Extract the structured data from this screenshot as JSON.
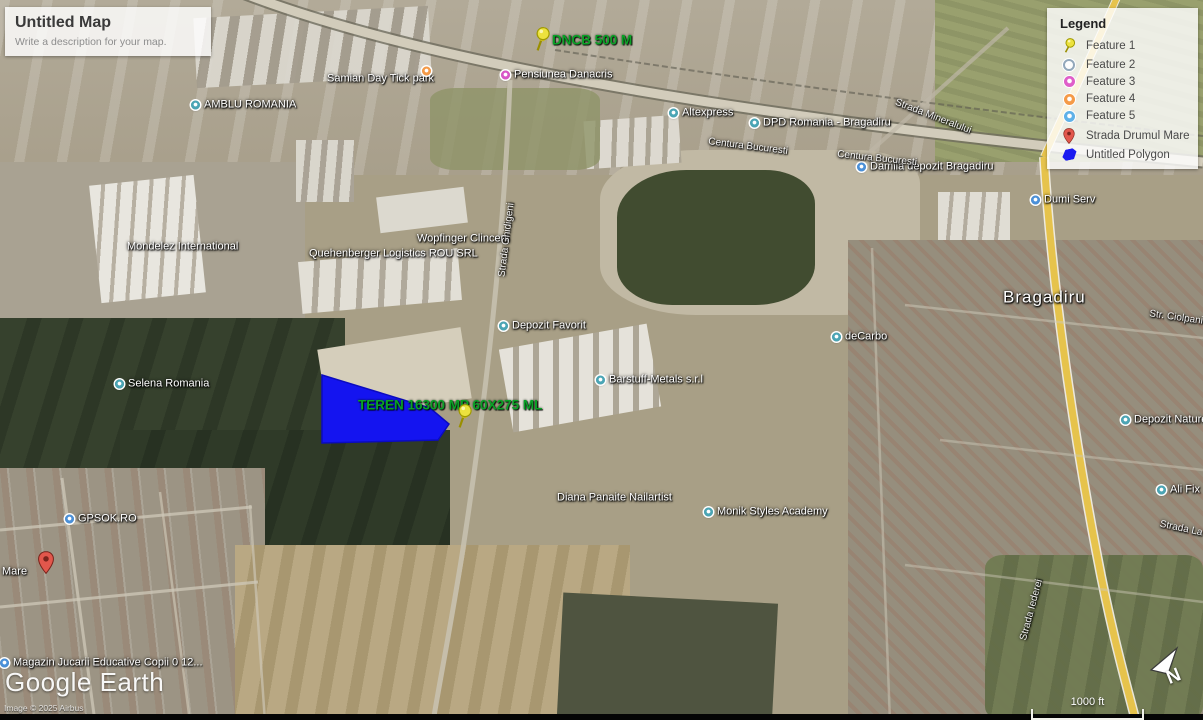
{
  "map_panel": {
    "title": "Untitled Map",
    "description": "Write a description for your map."
  },
  "legend": {
    "title": "Legend",
    "items": [
      {
        "label": "Feature 1",
        "icon": "pushpin",
        "color": "#ece23e"
      },
      {
        "label": "Feature 2",
        "icon": "ring",
        "color": "#93a8bb"
      },
      {
        "label": "Feature 3",
        "icon": "dot",
        "color": "#df5ec9"
      },
      {
        "label": "Feature 4",
        "icon": "dot",
        "color": "#f59a47"
      },
      {
        "label": "Feature 5",
        "icon": "dot",
        "color": "#5fb1e8"
      },
      {
        "label": "Strada Drumul Mare",
        "icon": "pin",
        "color": "#e2574c"
      },
      {
        "label": "Untitled Polygon",
        "icon": "polygon",
        "color": "#1a1af0"
      }
    ]
  },
  "colors": {
    "annotation_green": "#0aa226",
    "polygon_blue": "#1414f0",
    "pushpin_yellow": "#ece23e",
    "marker_red": "#e2574c"
  },
  "map": {
    "labels": [
      {
        "text": "DNCB 500 M",
        "type": "green",
        "x": 552,
        "y": 40
      },
      {
        "text": "TEREN 16300 MP 60X275 ML",
        "type": "green",
        "x": 358,
        "y": 405
      },
      {
        "text": "Samian Day Tick park",
        "type": "poi",
        "x": 327,
        "y": 79
      },
      {
        "text": "",
        "type": "poi",
        "icon": "#f59a47",
        "x": 422,
        "y": 71
      },
      {
        "text": "Pensiunea Danacris",
        "type": "poi",
        "icon": "#d856c8",
        "x": 501,
        "y": 75
      },
      {
        "text": "AMBLU ROMANIA",
        "type": "poi",
        "icon": "#4aa5b5",
        "x": 191,
        "y": 105
      },
      {
        "text": "Altexpress",
        "type": "poi",
        "icon": "#4aa5b5",
        "x": 669,
        "y": 113
      },
      {
        "text": "DPD Romania - Bragadiru",
        "type": "poi",
        "icon": "#4aa5b5",
        "x": 750,
        "y": 123
      },
      {
        "text": "Damila depozit Bragadiru",
        "type": "poi",
        "icon": "#4a90d9",
        "x": 857,
        "y": 167
      },
      {
        "text": "Dumi Serv",
        "type": "poi",
        "icon": "#4a90d9",
        "x": 1031,
        "y": 200
      },
      {
        "text": "Mondelez International",
        "type": "poi",
        "x": 127,
        "y": 247
      },
      {
        "text": "Wopfinger Clinceni",
        "type": "poi",
        "x": 417,
        "y": 239
      },
      {
        "text": "Quehenberger Logistics ROU SRL",
        "type": "poi",
        "x": 309,
        "y": 254
      },
      {
        "text": "Depozit Favorit",
        "type": "poi",
        "icon": "#4aa5b5",
        "x": 499,
        "y": 326
      },
      {
        "text": "deCarbo",
        "type": "poi",
        "icon": "#4aa5b5",
        "x": 832,
        "y": 337
      },
      {
        "text": "Selena Romania",
        "type": "poi",
        "icon": "#4aa5b5",
        "x": 115,
        "y": 384
      },
      {
        "text": "Barstuff-Metals s.r.l",
        "type": "poi",
        "icon": "#4aa5b5",
        "x": 596,
        "y": 380
      },
      {
        "text": "Depozit Nature",
        "type": "poi",
        "icon": "#4aa5b5",
        "x": 1121,
        "y": 420
      },
      {
        "text": "Ali Fix",
        "type": "poi",
        "icon": "#4aa5b5",
        "x": 1157,
        "y": 490
      },
      {
        "text": "Diana Panaite Nailartist",
        "type": "poi",
        "x": 557,
        "y": 498
      },
      {
        "text": "Monik Styles Academy",
        "type": "poi",
        "icon": "#4aa5b5",
        "x": 704,
        "y": 512
      },
      {
        "text": "GPSOK.RO",
        "type": "poi",
        "icon": "#4a90d9",
        "x": 65,
        "y": 519
      },
      {
        "text": "Mare",
        "type": "poi",
        "x": 2,
        "y": 572
      },
      {
        "text": "Magazin Jucarii Educative Copii 0 12...",
        "type": "poi",
        "icon": "#4a90d9",
        "x": 0,
        "y": 663
      },
      {
        "text": "Bragadiru",
        "type": "city",
        "x": 1003,
        "y": 297
      },
      {
        "text": "Centura Bucuresti",
        "type": "road",
        "x": 748,
        "y": 147,
        "rot": 7
      },
      {
        "text": "Centura Bucuresti",
        "type": "road",
        "x": 877,
        "y": 159,
        "rot": 6
      },
      {
        "text": "Strada Mineralului",
        "type": "road",
        "x": 933,
        "y": 117,
        "rot": 21
      },
      {
        "text": "Strada Ghidigeni",
        "type": "road",
        "x": 507,
        "y": 240,
        "rot": -83
      },
      {
        "text": "Str. Ciolpani",
        "type": "road",
        "x": 1176,
        "y": 318,
        "rot": 8
      },
      {
        "text": "Strada La",
        "type": "road",
        "x": 1181,
        "y": 529,
        "rot": 12
      },
      {
        "text": "Strada Iederei",
        "type": "road",
        "x": 1032,
        "y": 610,
        "rot": -75
      }
    ],
    "pins": [
      {
        "kind": "pushpin",
        "x": 533,
        "y": 27
      },
      {
        "kind": "pushpin",
        "x": 455,
        "y": 404
      },
      {
        "kind": "marker",
        "x": 38,
        "y": 551
      }
    ],
    "polygon": {
      "points": "322,375 430,408 449,424 438,440 322,443",
      "color": "#1414f0"
    }
  },
  "footer": {
    "logo": "Google Earth",
    "attribution": "Image © 2025 Airbus"
  },
  "scale": {
    "label": "1000 ft"
  },
  "compass": {
    "label": "N"
  }
}
